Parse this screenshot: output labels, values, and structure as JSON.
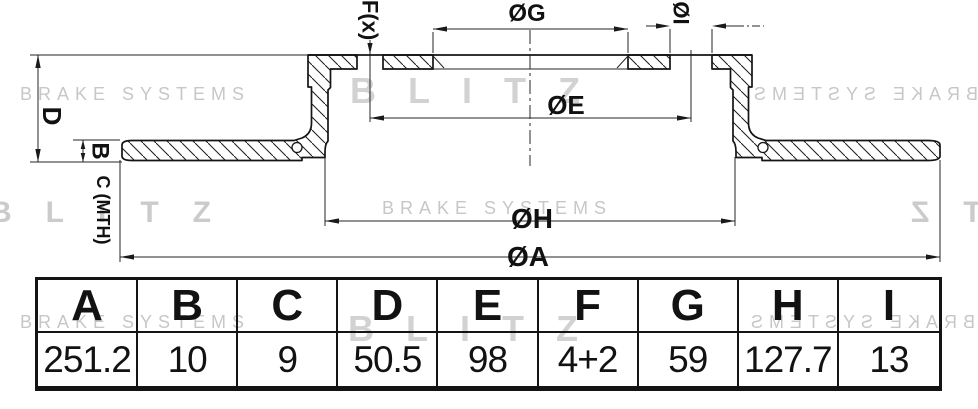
{
  "drawing": {
    "labels": {
      "fx": "F(x)",
      "g": "ØG",
      "i": "ØI",
      "e": "ØE",
      "h": "ØH",
      "a": "ØA",
      "d": "D",
      "b": "B",
      "c": "C (MTH)"
    }
  },
  "watermarks": {
    "brand": "BLITZ",
    "tagline": "BRAKE SYSTEMS"
  },
  "table": {
    "headers": [
      "A",
      "B",
      "C",
      "D",
      "E",
      "F",
      "G",
      "H",
      "I"
    ],
    "values": [
      "251.2",
      "10",
      "9",
      "50.5",
      "98",
      "4+2",
      "59",
      "127.7",
      "13"
    ]
  },
  "colors": {
    "line": "#1a1a1a",
    "outline": "#141414",
    "watermark_gray": "#c7c7c7",
    "watermark_light": "#d2d2d2",
    "table_border": "#141414"
  }
}
